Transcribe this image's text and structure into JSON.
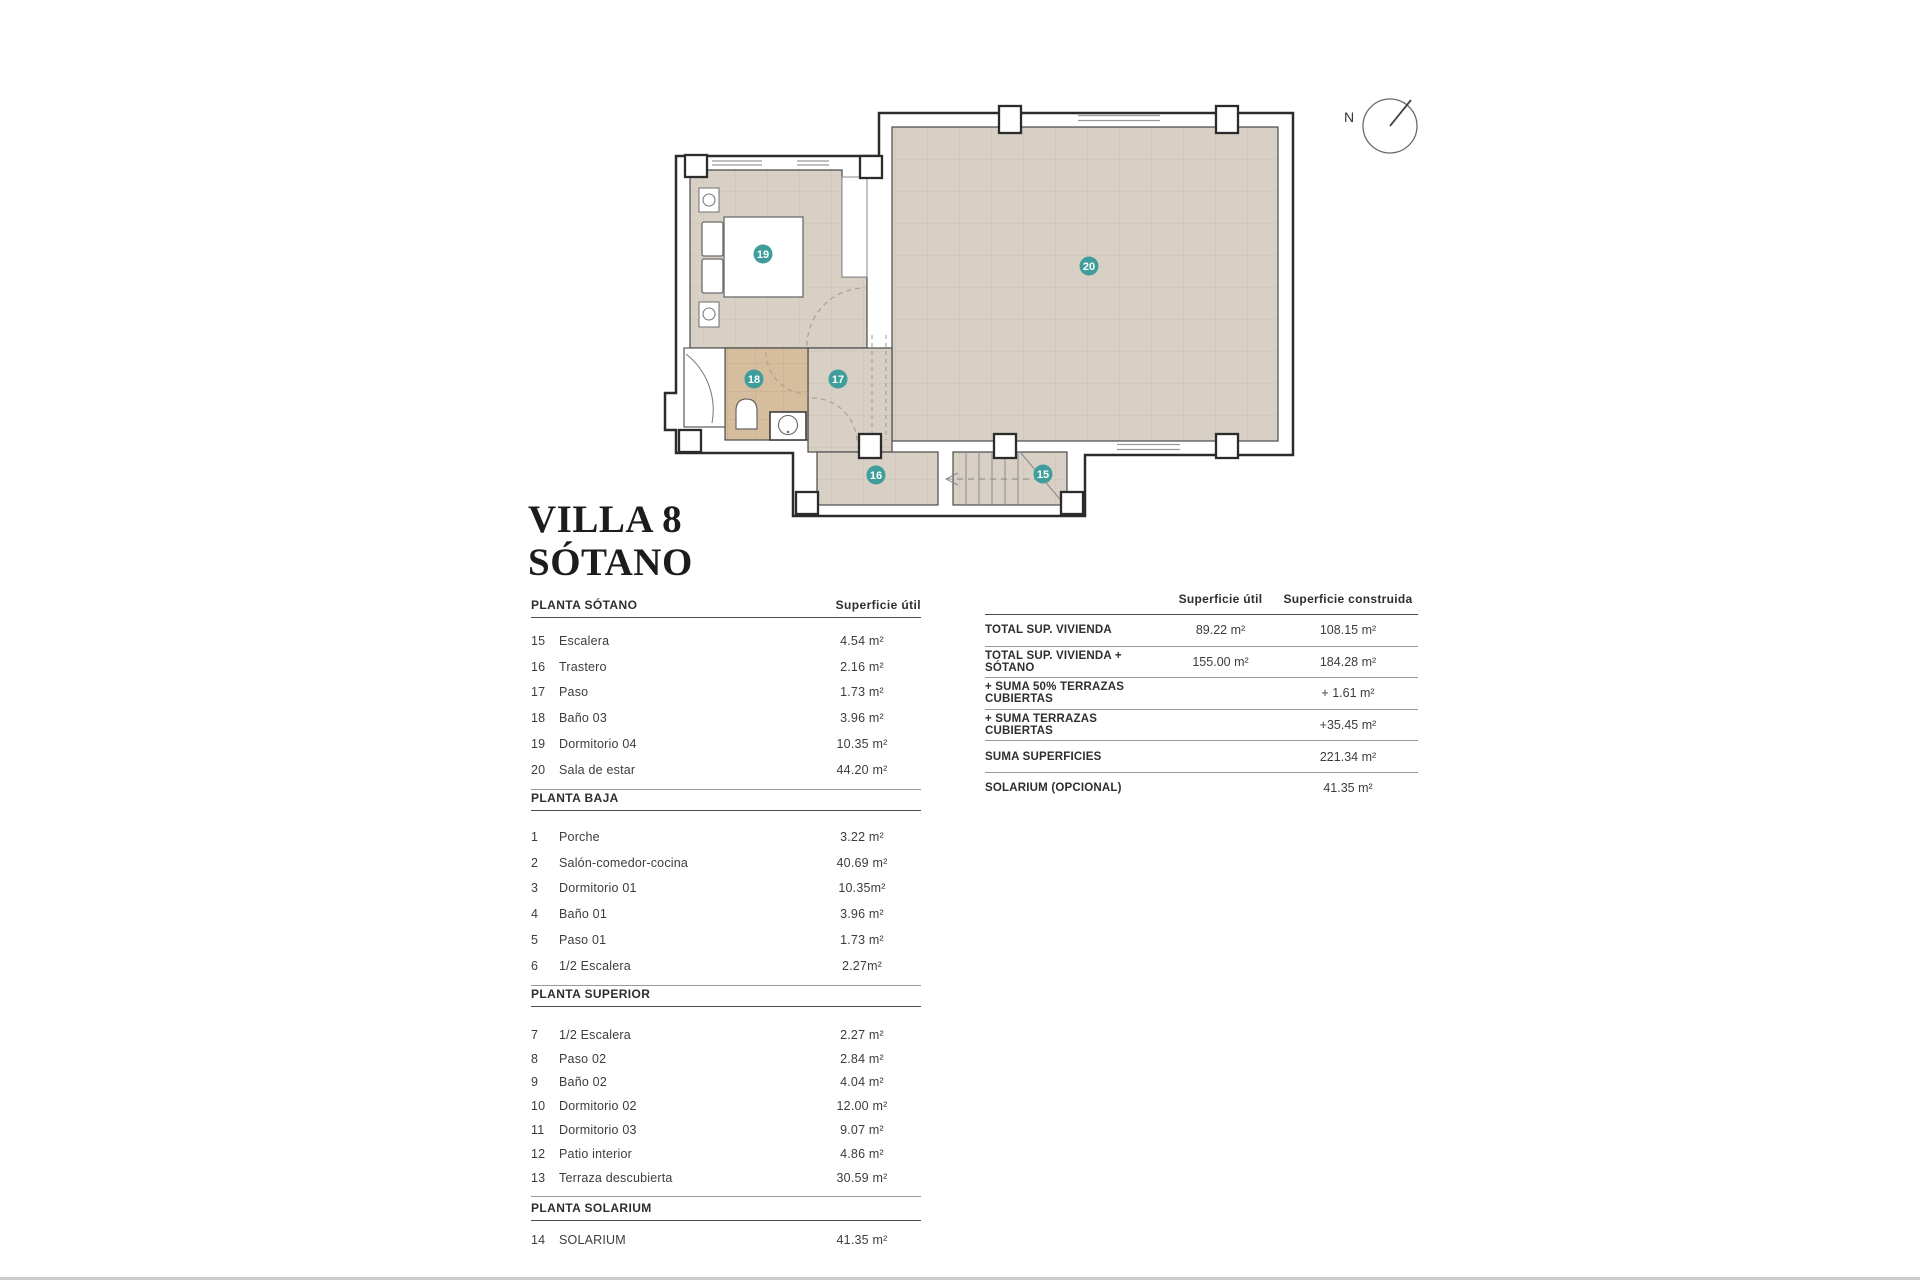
{
  "title": {
    "line1": "VILLA 8",
    "line2": "SÓTANO"
  },
  "plan": {
    "compass_label": "N",
    "badges": [
      "15",
      "16",
      "17",
      "18",
      "19",
      "20"
    ],
    "colors": {
      "floor": "#d9d0c5",
      "bath_floor": "#d6bd9e",
      "badge": "#3f9d9b",
      "wall_line": "#2b2b2b"
    }
  },
  "left_tables": [
    {
      "header": "PLANTA SÓTANO",
      "value_header": "Superficie útil",
      "rows": [
        {
          "num": "15",
          "label": "Escalera",
          "value": "4.54 m²"
        },
        {
          "num": "16",
          "label": "Trastero",
          "value": "2.16 m²"
        },
        {
          "num": "17",
          "label": "Paso",
          "value": "1.73 m²"
        },
        {
          "num": "18",
          "label": "Baño 03",
          "value": "3.96 m²"
        },
        {
          "num": "19",
          "label": "Dormitorio 04",
          "value": "10.35 m²"
        },
        {
          "num": "20",
          "label": "Sala de estar",
          "value": "44.20 m²"
        }
      ]
    },
    {
      "header": "PLANTA BAJA",
      "rows": [
        {
          "num": "1",
          "label": "Porche",
          "value": "3.22 m²"
        },
        {
          "num": "2",
          "label": "Salón-comedor-cocina",
          "value": "40.69 m²"
        },
        {
          "num": "3",
          "label": "Dormitorio 01",
          "value": "10.35m²"
        },
        {
          "num": "4",
          "label": "Baño 01",
          "value": "3.96 m²"
        },
        {
          "num": "5",
          "label": "Paso 01",
          "value": "1.73 m²"
        },
        {
          "num": "6",
          "label": "1/2 Escalera",
          "value": "2.27m²"
        }
      ]
    },
    {
      "header": "PLANTA SUPERIOR",
      "rows": [
        {
          "num": "7",
          "label": "1/2 Escalera",
          "value": "2.27 m²"
        },
        {
          "num": "8",
          "label": "Paso 02",
          "value": "2.84 m²"
        },
        {
          "num": "9",
          "label": "Baño 02",
          "value": "4.04 m²"
        },
        {
          "num": "10",
          "label": "Dormitorio 02",
          "value": "12.00 m²"
        },
        {
          "num": "11",
          "label": "Dormitorio 03",
          "value": "9.07 m²"
        },
        {
          "num": "12",
          "label": "Patio interior",
          "value": "4.86 m²"
        },
        {
          "num": "13",
          "label": "Terraza descubierta",
          "value": "30.59 m²"
        }
      ]
    },
    {
      "header": "PLANTA SOLARIUM",
      "rows": [
        {
          "num": "14",
          "label": "SOLARIUM",
          "value": "41.35 m²"
        }
      ]
    }
  ],
  "summary_table": {
    "col1_header": "Superficie útil",
    "col2_header": "Superficie construida",
    "rows": [
      {
        "label": "TOTAL SUP. VIVIENDA",
        "util": "89.22 m²",
        "construida": "108.15 m²"
      },
      {
        "label": "TOTAL SUP. VIVIENDA + SÓTANO",
        "util": "155.00 m²",
        "construida": "184.28 m²"
      },
      {
        "label": "+ SUMA 50% TERRAZAS CUBIERTAS",
        "util": "",
        "construida": "+ 1.61 m²"
      },
      {
        "label": "+ SUMA TERRAZAS CUBIERTAS",
        "util": "",
        "construida": "+35.45 m²"
      },
      {
        "label": "SUMA SUPERFICIES",
        "util": "",
        "construida": "221.34 m²"
      },
      {
        "label": "SOLARIUM (OPCIONAL)",
        "util": "",
        "construida": "41.35 m²"
      }
    ]
  }
}
